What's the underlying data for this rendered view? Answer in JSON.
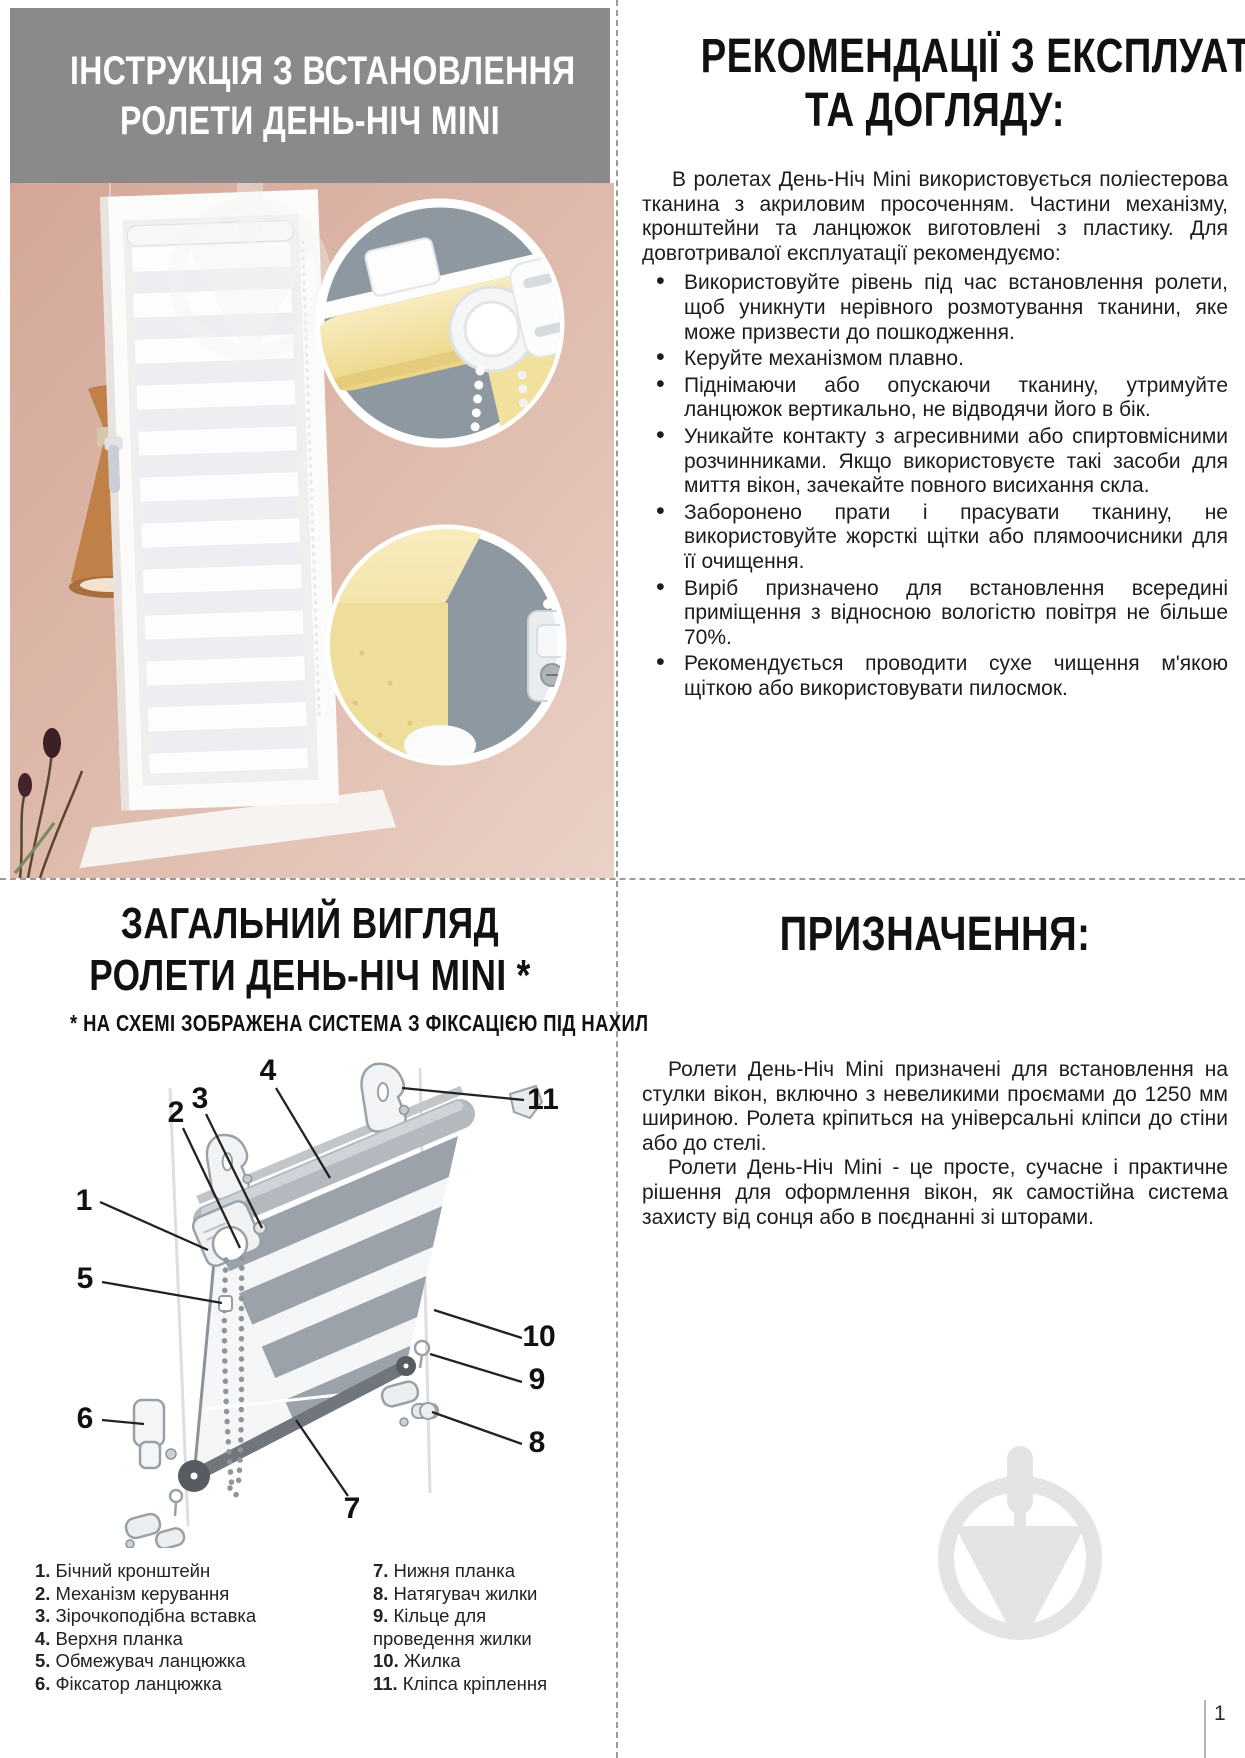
{
  "top_left": {
    "title_line1": "ІНСТРУКЦІЯ З ВСТАНОВЛЕННЯ",
    "title_line2": "РОЛЕТИ ДЕНЬ-НІЧ MINI"
  },
  "recommendations": {
    "heading_line1": "РЕКОМЕНДАЦІЇ З ЕКСПЛУАТАЦІЇ",
    "heading_line2": "ТА ДОГЛЯДУ:",
    "intro": "В ролетах День-Ніч Mini використовується поліестерова тканина з акриловим просоченням. Частини механізму, кронштейни та ланцюжок виготовлені з пластику. Для довготривалої експлуатації рекомендуємо:",
    "bullets": [
      "Використовуйте рівень під час встановлення ролети, щоб уникнути нерівного розмотування тканини, яке може призвести до пошкодження.",
      "Керуйте механізмом плавно.",
      "Піднімаючи або опускаючи тканину, утримуйте ланцюжок вертикально, не відводячи його в бік.",
      "Уникайте контакту з агресивними або спиртовмісними розчинниками. Якщо використовуєте такі засоби для миття вікон, зачекайте повного висихання скла.",
      "Заборонено прати і прасувати тканину, не використовуйте жорсткі щітки або плямоочисники для її очищення.",
      "Виріб призначено для встановлення всередині приміщення з відносною вологістю повітря не більше 70%.",
      "Рекомендується проводити сухе чищення м'якою щіткою або використовувати пилосмок."
    ]
  },
  "overview": {
    "heading_line1": "ЗАГАЛЬНИЙ ВИГЛЯД",
    "heading_line2": "РОЛЕТИ ДЕНЬ-НІЧ MINI *",
    "note": "* НА СХЕМІ ЗОБРАЖЕНА СИСТЕМА З ФІКСАЦІЄЮ ПІД НАХИЛ",
    "callouts": [
      "1",
      "2",
      "3",
      "4",
      "5",
      "6",
      "7",
      "8",
      "9",
      "10",
      "11"
    ],
    "legend_left": [
      {
        "num": "1.",
        "label": "Бічний кронштейн"
      },
      {
        "num": "2.",
        "label": "Механізм керування"
      },
      {
        "num": "3.",
        "label": "Зірочкоподібна вставка"
      },
      {
        "num": "4.",
        "label": "Верхня планка"
      },
      {
        "num": "5.",
        "label": "Обмежувач ланцюжка"
      },
      {
        "num": "6.",
        "label": "Фіксатор ланцюжка"
      }
    ],
    "legend_right": [
      {
        "num": "7.",
        "label": "Нижня планка"
      },
      {
        "num": "8.",
        "label": "Натягувач жилки"
      },
      {
        "num": "9.",
        "label": "Кільце для проведення жилки"
      },
      {
        "num": "10.",
        "label": "Жилка"
      },
      {
        "num": "11.",
        "label": "Кліпса кріплення"
      }
    ]
  },
  "purpose": {
    "heading": "ПРИЗНАЧЕННЯ:",
    "para1": "Ролети День-Ніч Mini призначені для встановлення на стулки вікон, включно з невеликими проємами до 1250 мм шириною. Ролета кріпиться на універсальні кліпси до стіни або до стелі.",
    "para2": "Ролети День-Ніч Mini - це просте, сучасне і практичне рішення для оформлення вікон, як самостійна система захисту від сонця або в поєднанні зі шторами."
  },
  "footer": {
    "page_number": "1"
  },
  "colors": {
    "header_gray": "#8a8a8a",
    "wall_pink": "#dcb3a5",
    "inset_slate": "#8d98a1",
    "fabric_yellow": "#f2dd96",
    "watermark_gray": "#e4e4e4",
    "text_black": "#1c1c1c"
  }
}
